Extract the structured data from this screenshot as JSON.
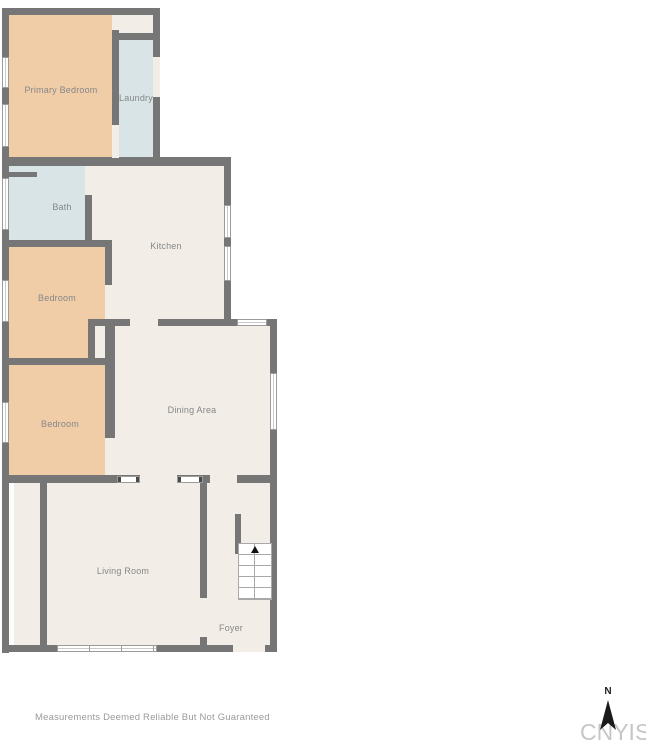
{
  "plan": {
    "rooms": {
      "primary_bedroom": {
        "label": "Primary Bedroom"
      },
      "laundry": {
        "label": "Laundry"
      },
      "bath": {
        "label": "Bath"
      },
      "kitchen": {
        "label": "Kitchen"
      },
      "bedroom_upper": {
        "label": "Bedroom"
      },
      "bedroom_lower": {
        "label": "Bedroom"
      },
      "dining": {
        "label": "Dining Area"
      },
      "living": {
        "label": "Living Room"
      },
      "foyer": {
        "label": "Foyer"
      }
    },
    "compass": {
      "north_label": "N"
    },
    "watermark": "CNYIS",
    "disclaimer": "Measurements Deemed Reliable But Not Guaranteed"
  },
  "colors": {
    "wall": "#767676",
    "bedroom_fill": "#f1cda7",
    "wet_room_fill": "#d8e4e5",
    "common_fill": "#f2ede6",
    "label_text": "#85878a",
    "watermark_text": "#c6c6c6",
    "disclaimer_text": "#9b9b9b",
    "background": "#ffffff"
  }
}
